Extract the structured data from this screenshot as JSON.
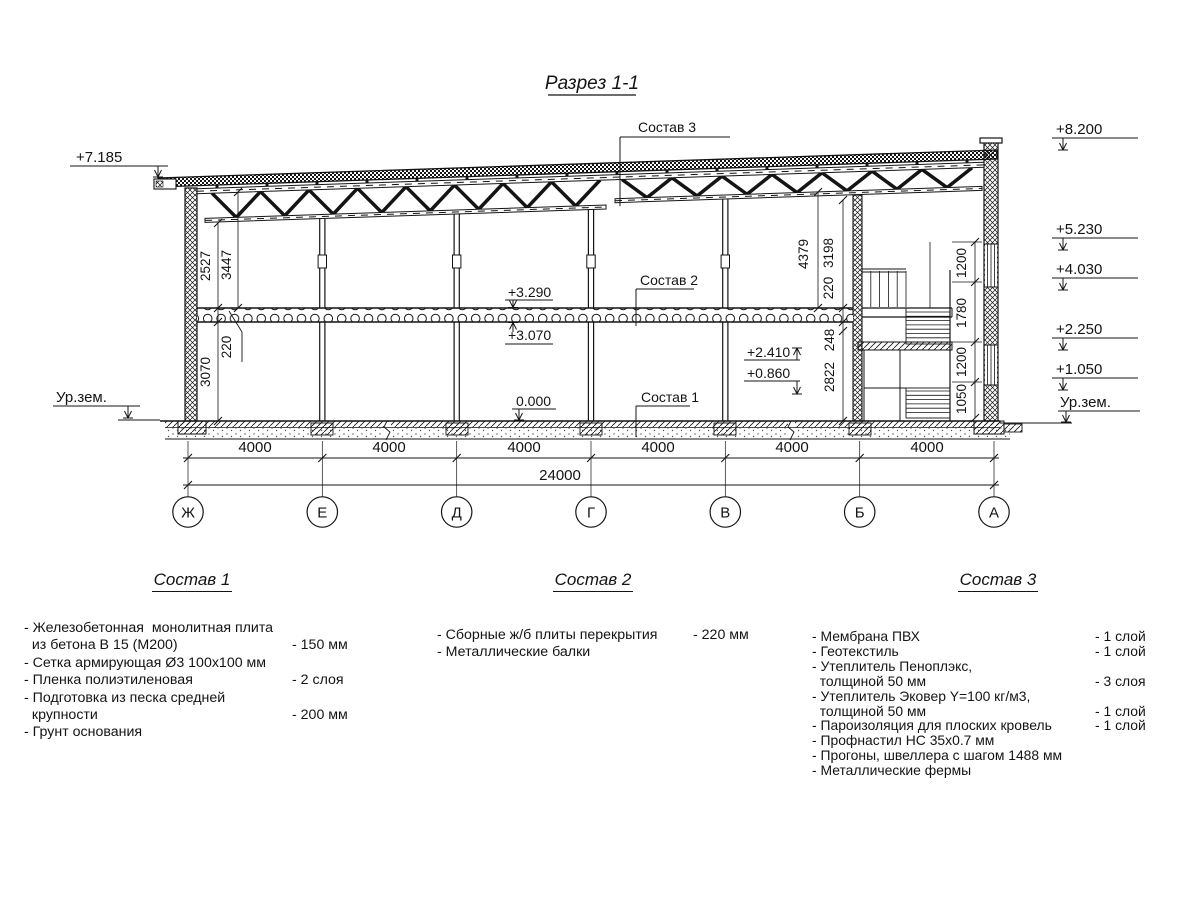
{
  "title": "Разрез 1-1",
  "drawing": {
    "elev_left_top": "+7.185",
    "elev_left_ground": "Ур.зем.",
    "elev_right": {
      "r1": "+8.200",
      "r2": "+5.230",
      "r3": "+4.030",
      "r4": "+2.250",
      "r5": "+1.050",
      "ground": "Ур.зем."
    },
    "levels": {
      "slab_top": "+3.290",
      "slab_bot": "+3.070",
      "zero": "0.000",
      "stair_a": "+2.410",
      "stair_b": "+0.860"
    },
    "dims": {
      "d2527": "2527",
      "d3447": "3447",
      "d220l": "220",
      "d3070": "3070",
      "d4379": "4379",
      "d3198": "3198",
      "d220r": "220",
      "d248": "248",
      "d2822": "2822",
      "s1200a": "1200",
      "s1780": "1780",
      "s1200b": "1200",
      "s1050": "1050"
    },
    "leaders": {
      "c1": "Состав 1",
      "c2": "Состав 2",
      "c3": "Состав 3"
    },
    "spans": [
      "4000",
      "4000",
      "4000",
      "4000",
      "4000",
      "4000"
    ],
    "total": "24000",
    "axes": [
      "Ж",
      "Е",
      "Д",
      "Г",
      "В",
      "Б",
      "А"
    ]
  },
  "comp1": {
    "title": "Состав 1",
    "lines": [
      {
        "t": "- Железобетонная  монолитная плита",
        "v": ""
      },
      {
        "t": "  из бетона В 15 (М200)",
        "v": "- 150 мм"
      },
      {
        "t": "- Сетка армирующая Ø3 100x100 мм",
        "v": ""
      },
      {
        "t": "- Пленка полиэтиленовая",
        "v": "-  2 слоя"
      },
      {
        "t": "- Подготовка из песка средней",
        "v": ""
      },
      {
        "t": "  крупности",
        "v": "- 200 мм"
      },
      {
        "t": "- Грунт основания",
        "v": ""
      }
    ]
  },
  "comp2": {
    "title": "Состав 2",
    "lines": [
      {
        "t": "- Сборные ж/б плиты перекрытия",
        "v": "- 220 мм"
      },
      {
        "t": "- Металлические балки",
        "v": ""
      }
    ]
  },
  "comp3": {
    "title": "Состав 3",
    "lines": [
      {
        "t": "- Мембрана ПВХ",
        "v": "- 1 слой"
      },
      {
        "t": "- Геотекстиль",
        "v": "- 1 слой"
      },
      {
        "t": "- Утеплитель Пеноплэкс,",
        "v": ""
      },
      {
        "t": "  толщиной 50 мм",
        "v": "- 3 слоя"
      },
      {
        "t": "- Утеплитель Эковер Y=100 кг/м3,",
        "v": ""
      },
      {
        "t": "  толщиной 50 мм",
        "v": "- 1 слой"
      },
      {
        "t": "- Пароизоляция для плоских кровель",
        "v": "- 1 слой"
      },
      {
        "t": "- Профнастил НС 35x0.7 мм",
        "v": ""
      },
      {
        "t": "- Прогоны, швеллера с шагом 1488 мм",
        "v": ""
      },
      {
        "t": "- Металлические фермы",
        "v": ""
      }
    ]
  }
}
